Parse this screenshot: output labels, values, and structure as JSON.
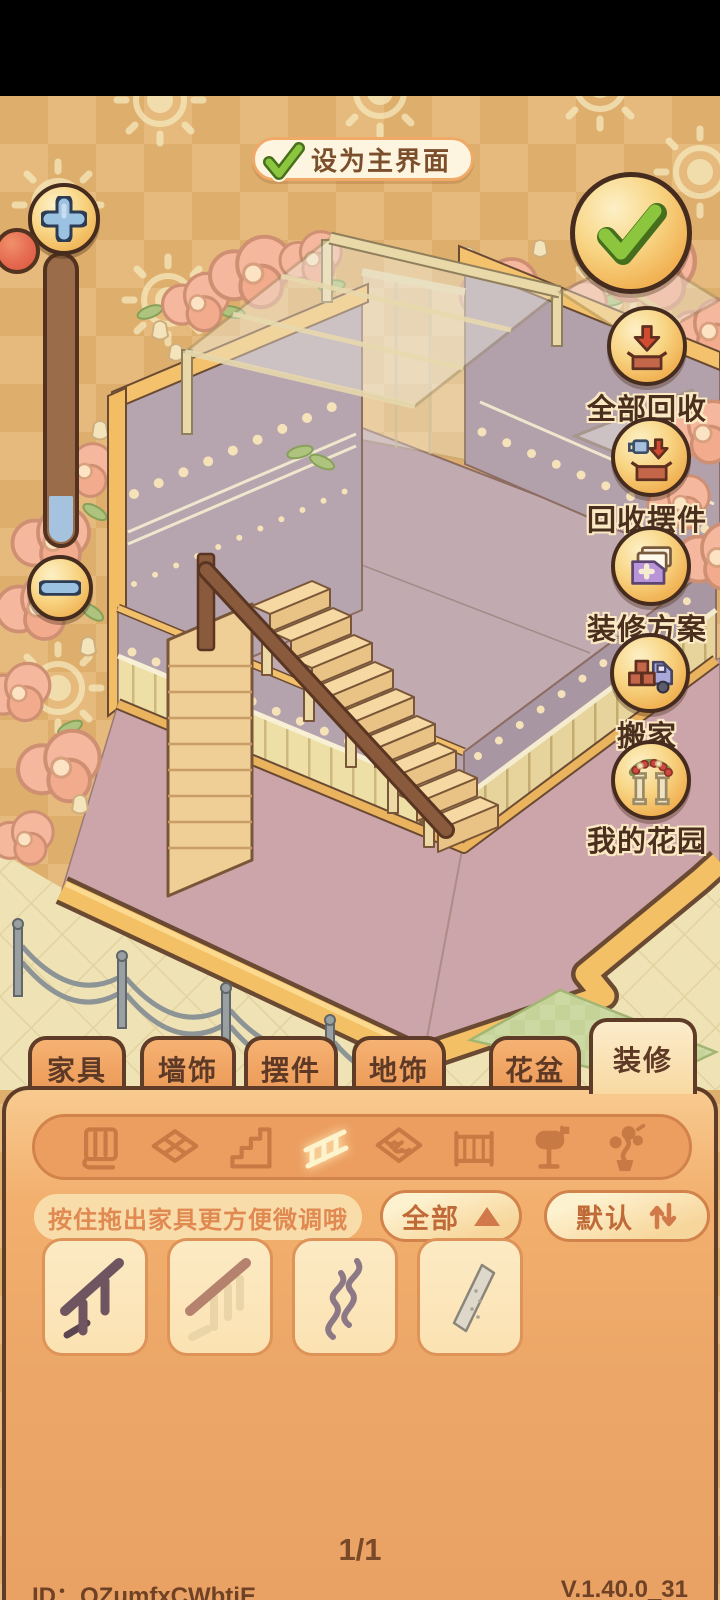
{
  "header": {
    "set_main_label": "设为主界面"
  },
  "toolbar": {
    "confirm_icon": "green-checkmark",
    "buttons": [
      {
        "id": "recycle-all",
        "label": "全部回收",
        "icon": "box-arrow-down"
      },
      {
        "id": "recycle-ornaments",
        "label": "回收摆件",
        "icon": "cup-box-arrow-down"
      },
      {
        "id": "decor-plans",
        "label": "装修方案",
        "icon": "cards-plus"
      },
      {
        "id": "move-house",
        "label": "搬家",
        "icon": "boxes-truck"
      },
      {
        "id": "my-garden",
        "label": "我的花园",
        "icon": "flower-arch-columns"
      }
    ]
  },
  "zoom_controls": {
    "plus_icon": "plus",
    "minus_icon": "minus",
    "slider": "vertical-zoom-slider"
  },
  "tabs": [
    {
      "label": "家具",
      "active": false
    },
    {
      "label": "墙饰",
      "active": false
    },
    {
      "label": "摆件",
      "active": false
    },
    {
      "label": "地饰",
      "active": false
    },
    {
      "label": "花盆",
      "active": false
    },
    {
      "label": "装修",
      "active": true
    }
  ],
  "category_bar": {
    "icons": [
      "wallpaper",
      "floor-tile",
      "stairs",
      "railing",
      "roof-tile",
      "fence",
      "mailbox",
      "plant-decor"
    ],
    "selected": "railing"
  },
  "hint": {
    "text": "按住拖出家具更方便微调哦"
  },
  "filters": {
    "all_label": "全部",
    "sort_label": "默认"
  },
  "items": [
    {
      "icon": "railing-dark-wood"
    },
    {
      "icon": "railing-light-wood"
    },
    {
      "icon": "railing-iron-scroll"
    },
    {
      "icon": "railing-glass-panel"
    }
  ],
  "pagination": {
    "label": "1/1"
  },
  "footer": {
    "player_id": "ID：QZumfxCWbtjE",
    "version": "V.1.40.0_31"
  },
  "colors": {
    "background_tan": "#e6ba7c",
    "wall_mauve": "#b5a3ae",
    "floor_pink": "#cca5aa",
    "wainscot_yellow": "#eedfa6",
    "trim_yellow": "#f4c066",
    "panel_orange": "#eca768",
    "tab_orange": "#ec9a57",
    "tab_active_cream": "#f8d9a2",
    "accent_brown": "#5e3c28",
    "confirm_green": "#8cc63e",
    "recycle_red": "#d14b30",
    "slider_knob_red": "#e4674e"
  }
}
